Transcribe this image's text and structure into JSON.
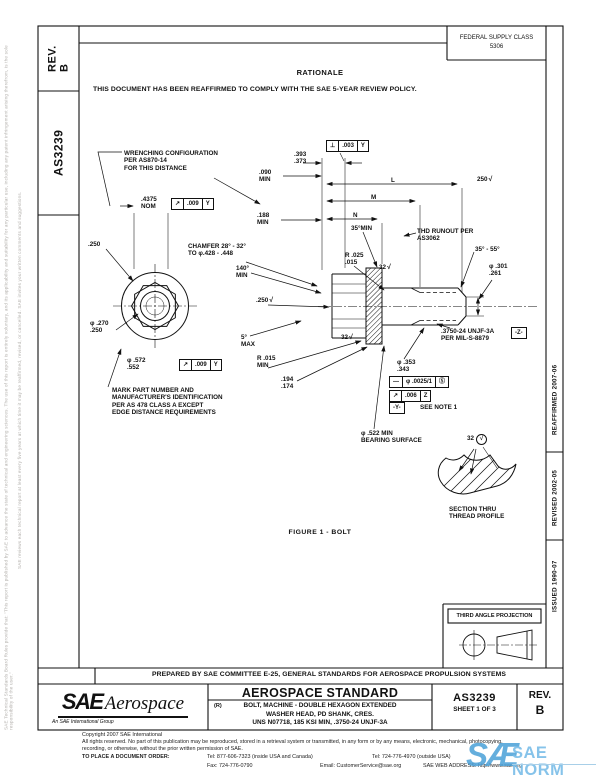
{
  "sidebar_left": {
    "rev_label": "REV.\nB",
    "doc_number": "AS3239",
    "disclaimer_line1": "SAE Technical Standards Board Rules provide that: \"This report is published by SAE to advance the state of technical and engineering sciences. The use of this report is entirely voluntary, and its applicability and suitability for any particular use, including any patent infringement arising therefrom, is the sole responsibility of the user.\"",
    "disclaimer_line2": "SAE reviews each technical report at least every five years at which time it may be reaffirmed, revised, or cancelled. SAE invites your written comments and suggestions."
  },
  "header": {
    "fsc_title": "FEDERAL SUPPLY CLASS",
    "fsc_code": "5306"
  },
  "rationale": {
    "title": "RATIONALE",
    "body": "THIS DOCUMENT HAS BEEN REAFFIRMED TO COMPLY WITH THE SAE 5-YEAR REVIEW POLICY."
  },
  "drawing": {
    "figure_caption": "FIGURE 1 - BOLT",
    "labels": [
      {
        "text": "WRENCHING CONFIGURATION\nPER AS870-14\nFOR THIS DISTANCE",
        "x": 124,
        "y": 150
      },
      {
        "text": ".393\n.373",
        "x": 294,
        "y": 151
      },
      {
        "text": ".090\nMIN",
        "x": 259,
        "y": 169
      },
      {
        "text": ".188\nMIN",
        "x": 257,
        "y": 212
      },
      {
        "text": "L",
        "x": 391,
        "y": 177
      },
      {
        "text": "M",
        "x": 371,
        "y": 194
      },
      {
        "text": "N",
        "x": 353,
        "y": 212
      },
      {
        "text": "35°MIN",
        "x": 351,
        "y": 225
      },
      {
        "text": "THD RUNOUT PER\nAS3062",
        "x": 417,
        "y": 228
      },
      {
        "text": "250",
        "x": 477,
        "y": 176,
        "check": true
      },
      {
        "text": ".250",
        "x": 88,
        "y": 241
      },
      {
        "text": ".4375\nNOM",
        "x": 141,
        "y": 196
      },
      {
        "text": "CHAMFER 28° - 32°\nTO φ.428 - .448",
        "x": 188,
        "y": 243
      },
      {
        "text": "140°\nMIN",
        "x": 236,
        "y": 265
      },
      {
        "text": "R .025\n.015",
        "x": 345,
        "y": 252
      },
      {
        "text": "32",
        "x": 379,
        "y": 264,
        "check": true
      },
      {
        "text": ".250",
        "x": 256,
        "y": 297,
        "check": true
      },
      {
        "text": "φ .270\n.250",
        "x": 90,
        "y": 320
      },
      {
        "text": "5°\nMAX",
        "x": 241,
        "y": 334
      },
      {
        "text": "32",
        "x": 341,
        "y": 334,
        "check": true
      },
      {
        "text": "φ .572\n.552",
        "x": 127,
        "y": 357
      },
      {
        "text": "R .015\nMIN",
        "x": 257,
        "y": 355
      },
      {
        "text": ".194\n.174",
        "x": 281,
        "y": 376
      },
      {
        "text": "MARK PART NUMBER AND\nMANUFACTURER'S IDENTIFICATION\nPER AS 478 CLASS A EXCEPT\nEDGE DISTANCE REQUIREMENTS",
        "x": 112,
        "y": 387
      },
      {
        "text": "35° - 55°",
        "x": 475,
        "y": 246
      },
      {
        "text": "φ .301\n.261",
        "x": 489,
        "y": 263
      },
      {
        "text": ".3750-24 UNJF-3A\nPER MIL-S-8879",
        "x": 441,
        "y": 328
      },
      {
        "text": "φ .353\n.343",
        "x": 397,
        "y": 359
      },
      {
        "text": "SEE NOTE 1",
        "x": 420,
        "y": 404
      },
      {
        "text": "φ .522 MIN\nBEARING SURFACE",
        "x": 361,
        "y": 430
      },
      {
        "text": "32",
        "x": 467,
        "y": 434,
        "check": true,
        "circled": true
      },
      {
        "text": "SECTION THRU\nTHREAD PROFILE",
        "x": 449,
        "y": 506
      }
    ],
    "frames": [
      {
        "cells": [
          "↗",
          ".009",
          "Y"
        ],
        "x": 171,
        "y": 198
      },
      {
        "cells": [
          "⊥",
          ".003",
          "Y"
        ],
        "x": 326,
        "y": 140
      },
      {
        "cells": [
          "↗",
          ".009",
          "Y"
        ],
        "x": 179,
        "y": 359
      },
      {
        "cells": [
          "—",
          "φ .0025/1",
          "Ⓢ"
        ],
        "x": 389,
        "y": 376
      },
      {
        "cells": [
          "↗",
          ".006",
          "Z"
        ],
        "x": 389,
        "y": 390
      }
    ],
    "datums": [
      {
        "text": "-Z-",
        "x": 511,
        "y": 327
      },
      {
        "text": "-Y-",
        "x": 389,
        "y": 402
      }
    ]
  },
  "side_column": {
    "reaffirmed": "REAFFIRMED 2007-06",
    "revised": "REVISED 2002-05",
    "issued": "ISSUED 1990-07"
  },
  "projection": {
    "label": "THIRD ANGLE PROJECTION"
  },
  "title_block": {
    "prepared_by": "PREPARED BY SAE COMMITTEE E-25, GENERAL STANDARDS FOR AEROSPACE PROPULSION SYSTEMS",
    "logo_main": "SAE",
    "logo_sub": "Aerospace",
    "logo_tagline": "An SAE International Group",
    "standard_type": "AEROSPACE STANDARD",
    "revised_mark": "(R)",
    "title_lines": "BOLT, MACHINE - DOUBLE HEXAGON EXTENDED\nWASHER HEAD, PD SHANK, CRES.\nUNS N07718, 185 KSI MIN, .3750-24 UNJF-3A",
    "doc_number": "AS3239",
    "sheet": "SHEET 1 OF 3",
    "rev_label": "REV.",
    "rev_value": "B"
  },
  "footer": {
    "copyright": "Copyright 2007 SAE International",
    "rights_line1": "All rights reserved. No part of this publication may be reproduced, stored in a retrieval system or transmitted, in any form or by any means, electronic, mechanical, photocopying,",
    "rights_line2": "recording, or otherwise, without the prior written permission of SAE.",
    "order_label": "TO PLACE A DOCUMENT ORDER:",
    "tel_inside": "Tel: 877-606-7323 (inside USA and Canada)",
    "tel_outside": "Tel: 724-776-4970 (outside USA)",
    "fax": "Fax: 724-776-0790",
    "email": "Email: CustomerService@sae.org",
    "web": "SAE WEB ADDRESS: http://www.sae.org"
  },
  "watermark": {
    "logo": "SÆ",
    "text": "SAE NORM"
  }
}
